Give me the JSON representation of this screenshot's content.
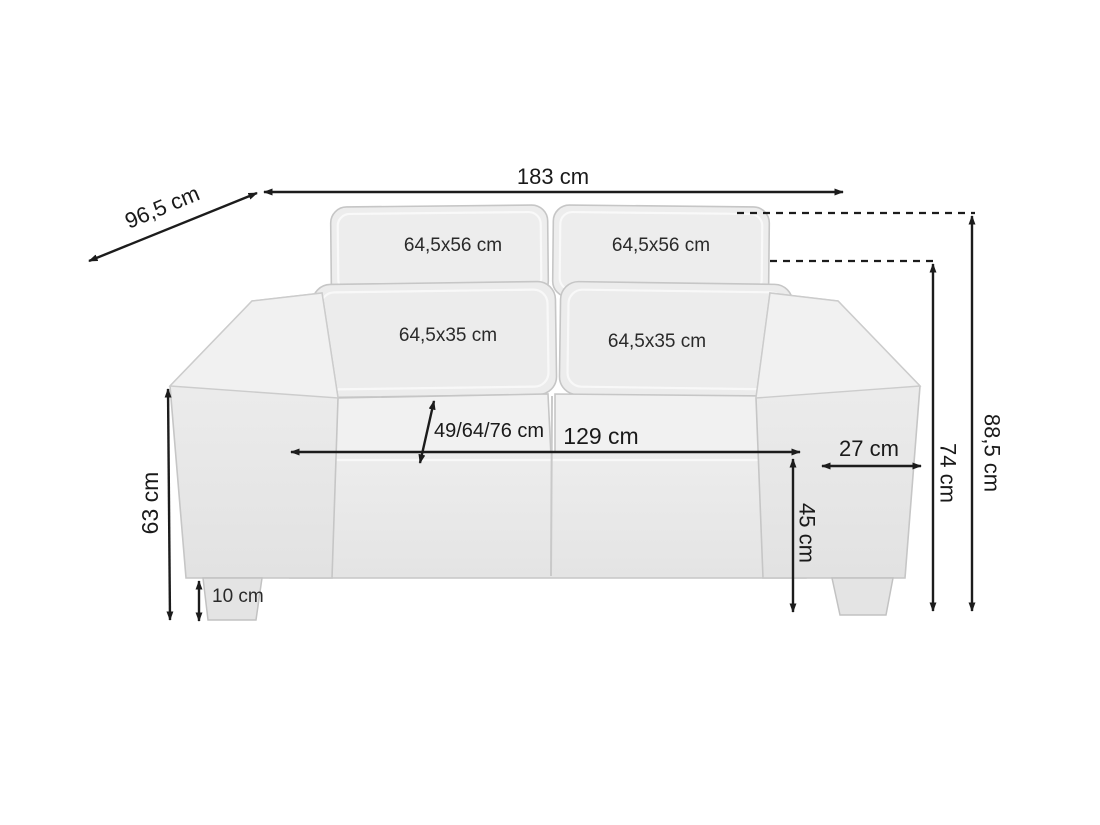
{
  "page": {
    "background": "#ffffff"
  },
  "colors": {
    "dimension_line": "#1c1c1c",
    "label_text": "#1a1a1a",
    "sofa_fill_light": "#f1f1f1",
    "sofa_fill": "#ebebeb",
    "sofa_fill_dark": "#e3e3e3",
    "sofa_outline": "#c6c6c6"
  },
  "diagram": {
    "type": "furniture-dimension-diagram",
    "subject": "two-seat sofa, front view with measurement arrows",
    "unit": "cm",
    "dimensions": {
      "overall_width": {
        "label": "183 cm",
        "value": 183
      },
      "overall_depth": {
        "label": "96,5 cm",
        "value": 96.5
      },
      "back_cushion_left": {
        "label": "64,5x56 cm"
      },
      "back_cushion_right": {
        "label": "64,5x56 cm"
      },
      "lumbar_cushion_left": {
        "label": "64,5x35 cm"
      },
      "lumbar_cushion_right": {
        "label": "64,5x35 cm"
      },
      "seat_depth_options": {
        "label": "49/64/76 cm"
      },
      "seat_width": {
        "label": "129 cm",
        "value": 129
      },
      "armrest_width": {
        "label": "27 cm",
        "value": 27
      },
      "seat_height": {
        "label": "45 cm",
        "value": 45
      },
      "armrest_height": {
        "label": "74 cm",
        "value": 74
      },
      "overall_height": {
        "label": "88,5 cm",
        "value": 88.5
      },
      "arm_outer_height": {
        "label": "63 cm",
        "value": 63
      },
      "leg_height": {
        "label": "10 cm",
        "value": 10
      }
    }
  }
}
